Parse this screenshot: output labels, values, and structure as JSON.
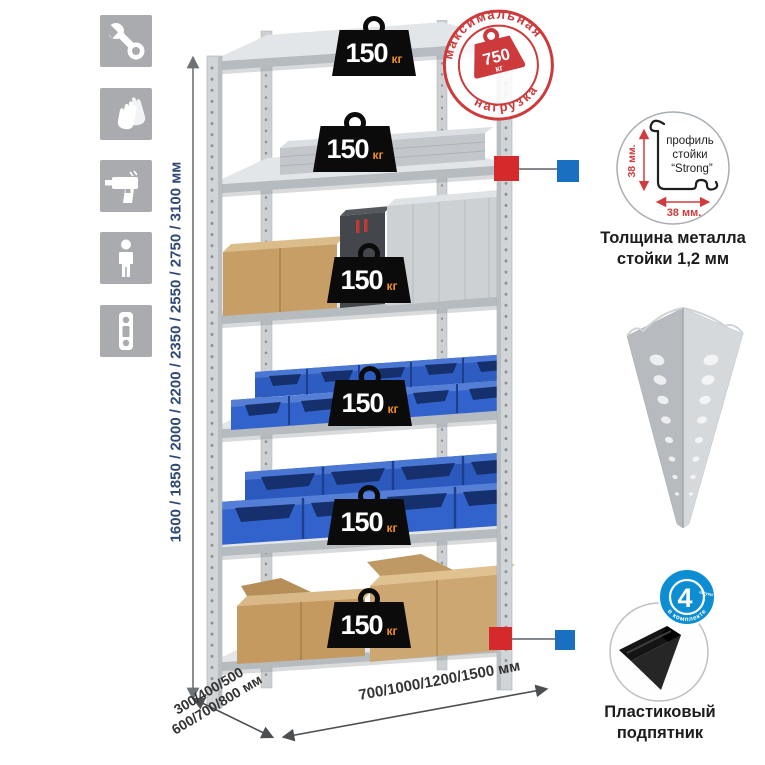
{
  "page": {
    "background": "#ffffff"
  },
  "sidebar": {
    "icons": [
      {
        "id": "wrench"
      },
      {
        "id": "gloves"
      },
      {
        "id": "drill"
      },
      {
        "id": "person"
      },
      {
        "id": "level"
      }
    ]
  },
  "stamp": {
    "arc_top": "максимальная",
    "arc_bottom": "нагрузка",
    "value": "750",
    "unit": "кг"
  },
  "rack": {
    "weight_badges": [
      {
        "value": "150",
        "unit": "кг"
      },
      {
        "value": "150",
        "unit": "кг"
      },
      {
        "value": "150",
        "unit": "кг"
      },
      {
        "value": "150",
        "unit": "кг"
      },
      {
        "value": "150",
        "unit": "кг"
      },
      {
        "value": "150",
        "unit": "кг"
      }
    ]
  },
  "dimensions": {
    "height": "1600 / 1850 / 2000 / 2200 / 2350 / 2550 / 2750 / 3100 мм",
    "depth_line1": "300/400/500",
    "depth_line2": "600/700/800 мм",
    "width": "700/1000/1200/1500 мм"
  },
  "profile_callout": {
    "line1": "профиль",
    "line2": "стойки",
    "line3": "“Strong”",
    "dim_vertical": "38 мм.",
    "dim_horizontal": "38 мм.",
    "caption1": "Толщина металла",
    "caption2": "стойки 1,2 мм"
  },
  "foot_callout": {
    "badge_number": "4",
    "badge_unit": "штуки",
    "badge_arc": "в комплекте",
    "caption1": "Пластиковый",
    "caption2": "подпятник"
  },
  "colors": {
    "stamp_red": "#cd3a3c",
    "badge_black": "#0b0b0b",
    "unit_orange": "#ef8f1f",
    "bin_blue": "#2e5cc0",
    "kit_badge_blue": "#0e8ed2",
    "connector_red": "#d42a2c",
    "connector_blue": "#1a6fc0",
    "metal_gray": "#d2d5d8",
    "icon_bg": "#a9abae",
    "dim_text": "#2e4a73"
  }
}
